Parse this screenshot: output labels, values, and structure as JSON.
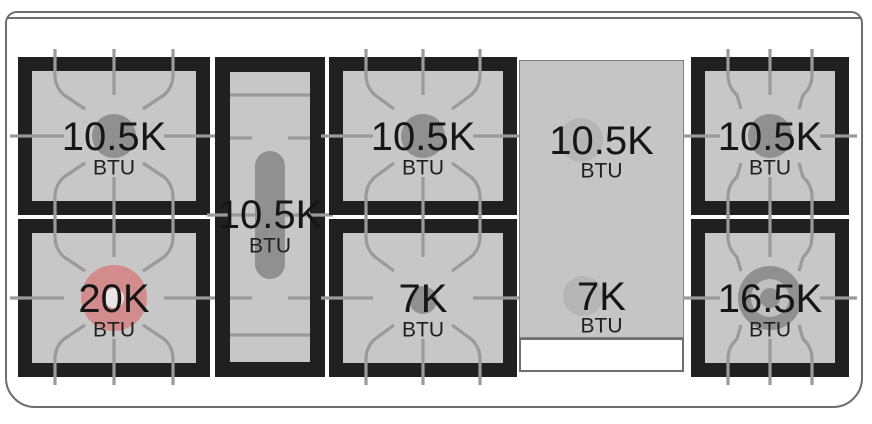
{
  "diagram": {
    "title": "Range cooktop burner BTU layout",
    "colors": {
      "grate_black": "#202020",
      "burner_bed_gray": "#c7c7c7",
      "grate_line_gray": "#9a9a9a",
      "cap_gray": "#909090",
      "cap_ring_light": "#c0c0c0",
      "highlight_red": "#d28c8c",
      "highlight_center": "#e9e6e4",
      "griddle_gray": "#c5c5c5",
      "frame_gray": "#6e6e6e",
      "label_black": "#161616"
    },
    "burners": [
      {
        "position": "back-left",
        "value": "10.5K",
        "unit": "BTU",
        "type": "standard",
        "cap": "single",
        "highlighted": false
      },
      {
        "position": "front-left",
        "value": "20K",
        "unit": "BTU",
        "type": "standard",
        "cap": "red",
        "highlighted": true
      },
      {
        "position": "center-oval",
        "value": "10.5K",
        "unit": "BTU",
        "type": "oval",
        "cap": "pill",
        "highlighted": false
      },
      {
        "position": "back-middle",
        "value": "10.5K",
        "unit": "BTU",
        "type": "standard",
        "cap": "single",
        "highlighted": false
      },
      {
        "position": "front-middle",
        "value": "7K",
        "unit": "BTU",
        "type": "standard",
        "cap": "small",
        "highlighted": false
      },
      {
        "position": "griddle-back",
        "value": "10.5K",
        "unit": "BTU",
        "type": "griddle",
        "cap": "flat",
        "highlighted": false
      },
      {
        "position": "griddle-front",
        "value": "7K",
        "unit": "BTU",
        "type": "griddle",
        "cap": "flat",
        "highlighted": false
      },
      {
        "position": "back-right",
        "value": "10.5K",
        "unit": "BTU",
        "type": "standard",
        "cap": "single",
        "highlighted": false
      },
      {
        "position": "front-right",
        "value": "16.5K",
        "unit": "BTU",
        "type": "dual-ring",
        "cap": "double",
        "highlighted": false
      }
    ]
  }
}
